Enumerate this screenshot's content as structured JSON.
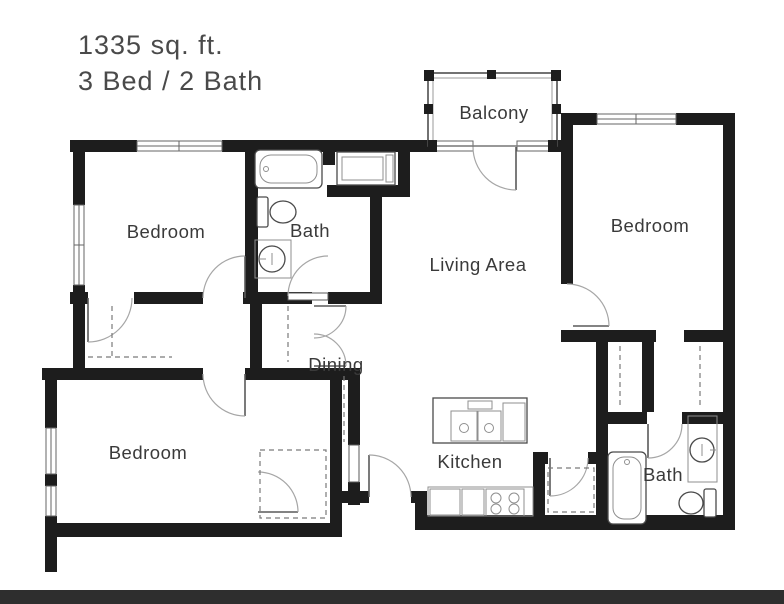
{
  "header": {
    "title_line1": "1335 sq. ft.",
    "title_line2": "3 Bed / 2 Bath",
    "area_sqft": "1335",
    "beds": "3",
    "baths": "2"
  },
  "rooms": {
    "bedroom_top_left": "Bedroom",
    "bath_top": "Bath",
    "living_area": "Living Area",
    "balcony": "Balcony",
    "bedroom_right": "Bedroom",
    "dining": "Dining",
    "bedroom_bottom_left": "Bedroom",
    "kitchen": "Kitchen",
    "bath_bottom_right": "Bath"
  },
  "fixtures": [
    "bathtub",
    "shower-stall",
    "toilet",
    "pedestal-sink",
    "kitchen-island-double-sink",
    "range-cooktop",
    "refrigerator-counter",
    "bathtub-2",
    "vanity-sink",
    "toilet-2",
    "closet-rod-dashes",
    "door-swing-arcs",
    "window-glyphs",
    "balcony-railing"
  ],
  "colors": {
    "wall": "#1d1d1d",
    "label_text": "#3a3a3a",
    "title_text": "#4a4a4a",
    "fixture_line": "#4a4a4a",
    "fixture_inner": "#8f8f8f",
    "door_arc": "#a6a6a6",
    "dashed_line": "#7a7a7a",
    "window_line": "#666666",
    "bottom_bar": "#2e2e2e",
    "background": "#ffffff"
  }
}
